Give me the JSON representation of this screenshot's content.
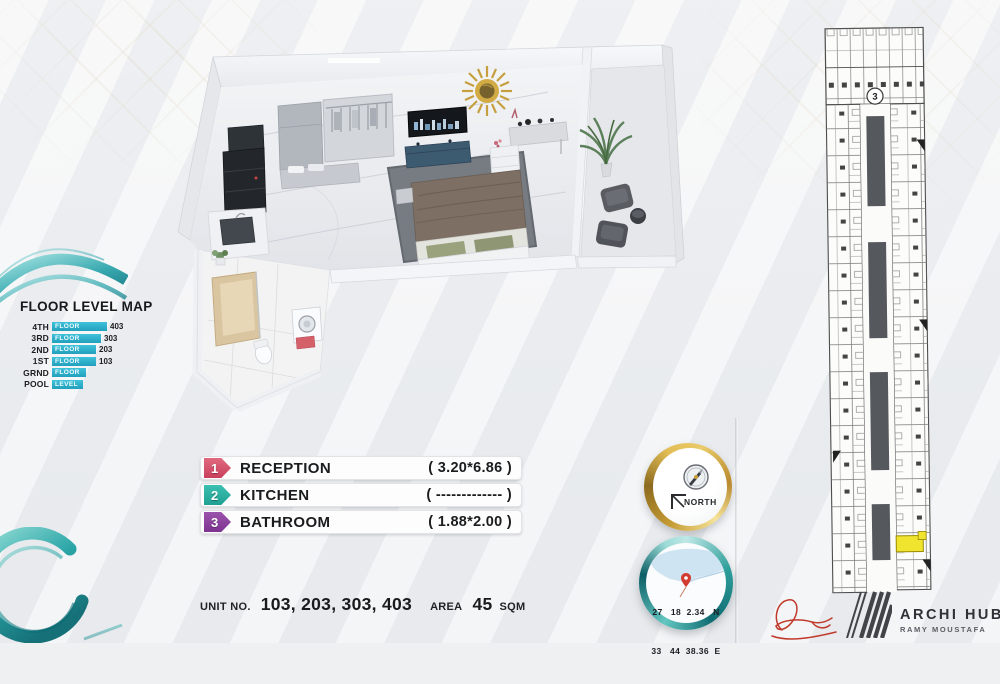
{
  "floor_map": {
    "title": "FLOOR LEVEL MAP",
    "rows": [
      {
        "label": "4TH",
        "bar_text": "FLOOR",
        "number": "403"
      },
      {
        "label": "3RD",
        "bar_text": "FLOOR",
        "number": "303"
      },
      {
        "label": "2ND",
        "bar_text": "FLOOR",
        "number": "203"
      },
      {
        "label": "1ST",
        "bar_text": "FLOOR",
        "number": "103"
      },
      {
        "label": "GRND",
        "bar_text": "FLOOR",
        "number": ""
      },
      {
        "label": "POOL",
        "bar_text": "LEVEL",
        "number": ""
      }
    ]
  },
  "legend": {
    "items": [
      {
        "num": "1",
        "label": "RECEPTION",
        "dims": "( 3.20*6.86 )",
        "color": "#d94f66"
      },
      {
        "num": "2",
        "label": "KITCHEN",
        "dims": "( ------------- )",
        "color": "#2bb1a3"
      },
      {
        "num": "3",
        "label": "BATHROOM",
        "dims": "( 1.88*2.00 )",
        "color": "#8d3fa0"
      }
    ]
  },
  "unit_info": {
    "unit_label": "UNIT NO.",
    "unit_numbers": "103, 203, 303, 403",
    "area_label": "AREA",
    "area_value": "45",
    "area_unit": "SQM"
  },
  "compass": {
    "label": "NORTH"
  },
  "location": {
    "line1": "27   18  2.34   N",
    "line2": "33   44  38.36  E"
  },
  "branding": {
    "name": "ARCHI HUB",
    "subtitle": "RAMY MOUSTAFA"
  },
  "site_plan": {
    "building_number": "3"
  },
  "colors": {
    "teal_accent": "#2fb3cd",
    "gold": "#c9a23a",
    "highlight_unit": "#f0e42e",
    "reception_badge": "#d94f66",
    "kitchen_badge": "#2bb1a3",
    "bathroom_badge": "#8d3fa0",
    "signature_red": "#c0392b"
  }
}
